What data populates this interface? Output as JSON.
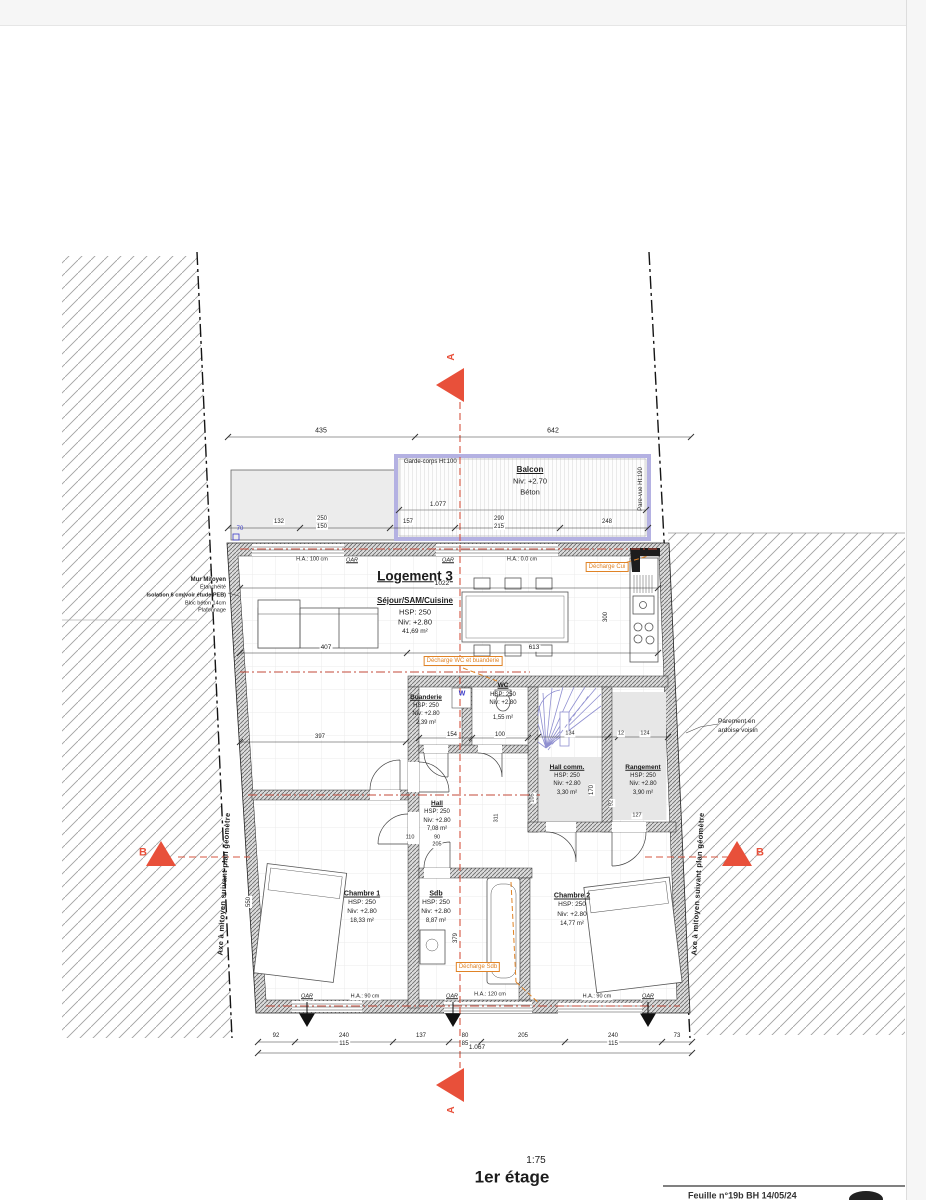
{
  "sheet": {
    "scale": "1:75",
    "title": "1er étage",
    "footer": "Feuille n°19b   BH   14/05/24"
  },
  "unit_title": "Logement 3",
  "axis_note": "Axe à mitoyen suivant plan géomètre",
  "party_wall_note": [
    "Mur Mitoyen",
    "Étanchéité",
    "Isolation 6 cm(voir étude PEB)",
    "Bloc béton 14cm",
    "Plafonnage"
  ],
  "neighbor_note": [
    "Parement en",
    "ardoise voisin"
  ],
  "markers": {
    "a": "A",
    "b": "B"
  },
  "balcony": {
    "name": "Balcon",
    "level": "Niv: +2.70",
    "material": "Béton",
    "railing": "Garde-corps Ht:100",
    "screen": "Pare-vue Ht:190"
  },
  "rooms": {
    "sejour": {
      "name": "Séjour/SAM/Cuisine",
      "hsp": "HSP: 250",
      "niv": "Niv: +2.80",
      "area": "41,69 m²"
    },
    "buanderie": {
      "name": "Buanderie",
      "hsp": "HSP: 250",
      "niv": "Niv: +2.80",
      "area": "2,39 m²"
    },
    "wc": {
      "name": "WC",
      "hsp": "HSP: 250",
      "niv": "Niv: +2.80",
      "area": "1,55 m²"
    },
    "hall_comm": {
      "name": "Hall comm.",
      "hsp": "HSP: 250",
      "niv": "Niv: +2.80",
      "area": "3,30 m²"
    },
    "rangement": {
      "name": "Rangement",
      "hsp": "HSP: 250",
      "niv": "Niv: +2.80",
      "area": "3,90 m²"
    },
    "hall": {
      "name": "Hall",
      "hsp": "HSP: 250",
      "niv": "Niv: +2.80",
      "area": "7,08 m²"
    },
    "chambre1": {
      "name": "Chambre 1",
      "hsp": "HSP: 250",
      "niv": "Niv: +2.80",
      "area": "18,33 m²"
    },
    "sdb": {
      "name": "Sdb",
      "hsp": "HSP: 250",
      "niv": "Niv: +2.80",
      "area": "8,87 m²"
    },
    "chambre2": {
      "name": "Chambre 2",
      "hsp": "HSP: 250",
      "niv": "Niv: +2.80",
      "area": "14,77 m²"
    }
  },
  "plumbing": {
    "cuisine": "Décharge Cui",
    "wc": "Décharge WC et buanderie",
    "sdb": "Décharge Sdb"
  },
  "wall_labels": {
    "oar": "OAR",
    "ha100": "H.A.: 100 cm",
    "ha0": "H.A.: 0.0 cm",
    "ha90": "H.A.: 90 cm",
    "ha120": "H.A.: 120 cm",
    "w": "W",
    "d70": "70"
  },
  "dims": {
    "top": [
      "435",
      "642"
    ],
    "balcony_width": "1.077",
    "row2": [
      "132",
      "250",
      "150",
      "157",
      "290",
      "215",
      "248"
    ],
    "sejour_width": "1022",
    "d407": "407",
    "d613": "613",
    "d300": "300",
    "d397": "397",
    "d154": "154",
    "d100": "100",
    "d134": "134",
    "d12": "12",
    "d124": "124",
    "d170": "170",
    "d92": "92",
    "d127": "127",
    "d105": "105",
    "d110": "110",
    "d90": "90",
    "d205": "205",
    "d311": "311",
    "d550": "550",
    "d379": "379",
    "bottom": [
      "92",
      "240",
      "115",
      "137",
      "80",
      "85",
      "205",
      "240",
      "115",
      "73"
    ],
    "total": "1.067"
  }
}
